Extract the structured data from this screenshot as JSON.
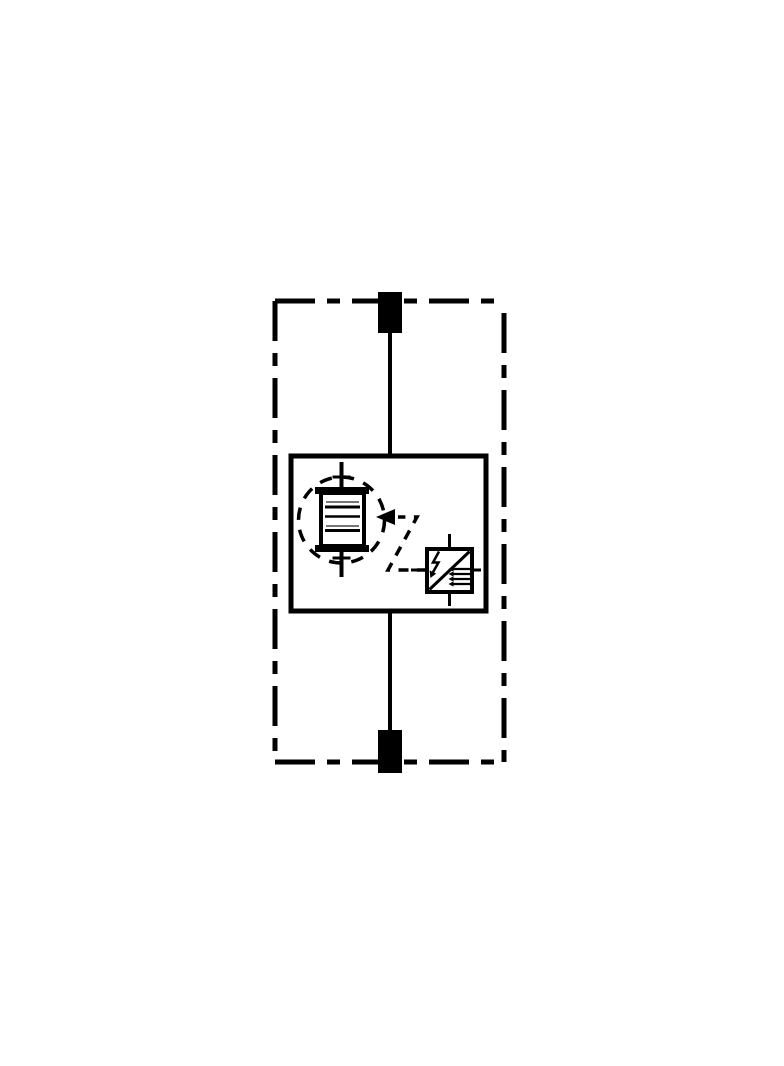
{
  "meta": {
    "description": "Circuit schematic of a surge protective device: dashed enclosure with two terminals, a protection module containing an encircled multi-layer spark-gap stack triggered via a dashed arrow path by a trigger-electronics unit marked with a lightning bolt",
    "type": "circuit-schematic"
  },
  "colors": {
    "ink": "#000000",
    "background": "#ffffff",
    "muted": "#777777"
  },
  "components": {
    "enclosure": "dashed device enclosure outline",
    "terminal_top": "upper connection terminal",
    "terminal_bottom": "lower connection terminal",
    "conductor": "main conductor path",
    "module": "protection module box",
    "spark_gap_stack": "multi-layer spark-gap stack",
    "spark_gap_boundary": "dashed circle component boundary",
    "trigger_line": "dashed trigger path with arrow",
    "trigger_unit": "trigger electronics unit",
    "lightning_bolt": "lightning-bolt symbol",
    "electrode_comb": "electrode stack symbol"
  }
}
